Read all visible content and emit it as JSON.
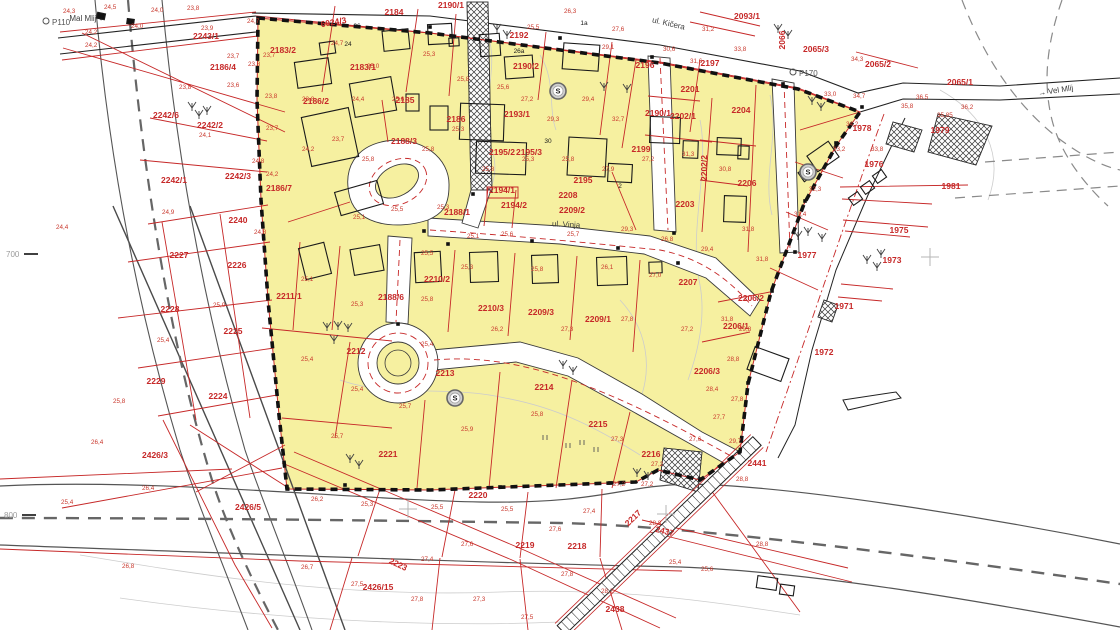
{
  "colors": {
    "zone_fill": "#F6F0A0",
    "parcel_line": "#C62828",
    "boundary": "#111111",
    "road_edge": "#555555",
    "centerline": "#666666",
    "contour": "#cccccc"
  },
  "labels": {
    "parcels": [
      {
        "t": "2243/1",
        "x": 206,
        "y": 39
      },
      {
        "t": "2186/4",
        "x": 223,
        "y": 70
      },
      {
        "t": "2242/6",
        "x": 166,
        "y": 118
      },
      {
        "t": "2242/2",
        "x": 210,
        "y": 128
      },
      {
        "t": "2242/1",
        "x": 174,
        "y": 183
      },
      {
        "t": "2242/3",
        "x": 238,
        "y": 179
      },
      {
        "t": "2240",
        "x": 238,
        "y": 223
      },
      {
        "t": "2227",
        "x": 179,
        "y": 258
      },
      {
        "t": "2226",
        "x": 237,
        "y": 268
      },
      {
        "t": "2228",
        "x": 170,
        "y": 312
      },
      {
        "t": "2225",
        "x": 233,
        "y": 334
      },
      {
        "t": "2229",
        "x": 156,
        "y": 384
      },
      {
        "t": "2224",
        "x": 218,
        "y": 399
      },
      {
        "t": "2426/3",
        "x": 155,
        "y": 458
      },
      {
        "t": "2426/5",
        "x": 248,
        "y": 510
      },
      {
        "t": "6024/3",
        "x": 334,
        "y": 25,
        "r": -10
      },
      {
        "t": "2184",
        "x": 394,
        "y": 15
      },
      {
        "t": "2190/1",
        "x": 451,
        "y": 8
      },
      {
        "t": "2192",
        "x": 519,
        "y": 38
      },
      {
        "t": "2093/1",
        "x": 747,
        "y": 19
      },
      {
        "t": "2065/3",
        "x": 816,
        "y": 52
      },
      {
        "t": "2065/2",
        "x": 878,
        "y": 67
      },
      {
        "t": "2065/1",
        "x": 960,
        "y": 85
      },
      {
        "t": "2183/2",
        "x": 283,
        "y": 53
      },
      {
        "t": "2183/1",
        "x": 363,
        "y": 70
      },
      {
        "t": "2190/2",
        "x": 526,
        "y": 69
      },
      {
        "t": "2185",
        "x": 405,
        "y": 103
      },
      {
        "t": "2186/2",
        "x": 316,
        "y": 104
      },
      {
        "t": "2186",
        "x": 456,
        "y": 122
      },
      {
        "t": "2190/1",
        "x": 658,
        "y": 116
      },
      {
        "t": "2193/1",
        "x": 517,
        "y": 117
      },
      {
        "t": "2188/3",
        "x": 404,
        "y": 144
      },
      {
        "t": "2196",
        "x": 645,
        "y": 68
      },
      {
        "t": "2197",
        "x": 710,
        "y": 66
      },
      {
        "t": "2201",
        "x": 690,
        "y": 92
      },
      {
        "t": "2202/1",
        "x": 683,
        "y": 119
      },
      {
        "t": "2202/2",
        "x": 707,
        "y": 168,
        "r": -90
      },
      {
        "t": "2204",
        "x": 741,
        "y": 113
      },
      {
        "t": "2066",
        "x": 785,
        "y": 40,
        "r": -90
      },
      {
        "t": "2199",
        "x": 641,
        "y": 152
      },
      {
        "t": "2195/2",
        "x": 502,
        "y": 155
      },
      {
        "t": "2195/3",
        "x": 529,
        "y": 155
      },
      {
        "t": "2186/7",
        "x": 279,
        "y": 191
      },
      {
        "t": "2195",
        "x": 583,
        "y": 183
      },
      {
        "t": "2208",
        "x": 568,
        "y": 198
      },
      {
        "t": "2203",
        "x": 685,
        "y": 207
      },
      {
        "t": "2206",
        "x": 747,
        "y": 186
      },
      {
        "t": "1978",
        "x": 862,
        "y": 131
      },
      {
        "t": "1979",
        "x": 940,
        "y": 133
      },
      {
        "t": "1976",
        "x": 874,
        "y": 167
      },
      {
        "t": "1981",
        "x": 951,
        "y": 189
      },
      {
        "t": "1977",
        "x": 807,
        "y": 258
      },
      {
        "t": "1975",
        "x": 899,
        "y": 233
      },
      {
        "t": "1973",
        "x": 892,
        "y": 263
      },
      {
        "t": "1971",
        "x": 844,
        "y": 309
      },
      {
        "t": "1972",
        "x": 824,
        "y": 355
      },
      {
        "t": "2188/1",
        "x": 457,
        "y": 215
      },
      {
        "t": "2194/1",
        "x": 502,
        "y": 193
      },
      {
        "t": "2194/2",
        "x": 514,
        "y": 208
      },
      {
        "t": "2209/2",
        "x": 572,
        "y": 213
      },
      {
        "t": "2211/1",
        "x": 289,
        "y": 299
      },
      {
        "t": "2188/6",
        "x": 391,
        "y": 300
      },
      {
        "t": "2210/2",
        "x": 437,
        "y": 282
      },
      {
        "t": "2210/3",
        "x": 491,
        "y": 311
      },
      {
        "t": "2209/3",
        "x": 541,
        "y": 315
      },
      {
        "t": "2209/1",
        "x": 598,
        "y": 322
      },
      {
        "t": "2207",
        "x": 688,
        "y": 285
      },
      {
        "t": "2206/2",
        "x": 751,
        "y": 301
      },
      {
        "t": "2206/1",
        "x": 736,
        "y": 329
      },
      {
        "t": "2206/3",
        "x": 707,
        "y": 374
      },
      {
        "t": "2212",
        "x": 356,
        "y": 354
      },
      {
        "t": "2213",
        "x": 445,
        "y": 376
      },
      {
        "t": "2214",
        "x": 544,
        "y": 390
      },
      {
        "t": "2215",
        "x": 598,
        "y": 427
      },
      {
        "t": "2216",
        "x": 651,
        "y": 457
      },
      {
        "t": "2221",
        "x": 388,
        "y": 457
      },
      {
        "t": "2220",
        "x": 478,
        "y": 498
      },
      {
        "t": "2219",
        "x": 525,
        "y": 548
      },
      {
        "t": "2218",
        "x": 577,
        "y": 549
      },
      {
        "t": "2223",
        "x": 397,
        "y": 567,
        "r": 25
      },
      {
        "t": "2426/15",
        "x": 378,
        "y": 590
      },
      {
        "t": "2217",
        "x": 635,
        "y": 520,
        "r": -44
      },
      {
        "t": "2437",
        "x": 664,
        "y": 534,
        "r": 14
      },
      {
        "t": "2438",
        "x": 615,
        "y": 612
      },
      {
        "t": "2441",
        "x": 757,
        "y": 466
      }
    ],
    "elevations": [
      [
        104,
        9,
        "24,5"
      ],
      [
        63,
        13,
        "24,3"
      ],
      [
        151,
        12,
        "24,0"
      ],
      [
        187,
        10,
        "23,8"
      ],
      [
        247,
        23,
        "24,7"
      ],
      [
        85,
        34,
        "24,2"
      ],
      [
        131,
        28,
        "24,0"
      ],
      [
        201,
        30,
        "23,9"
      ],
      [
        85,
        47,
        "24,2"
      ],
      [
        227,
        58,
        "23,7"
      ],
      [
        263,
        57,
        "23,7"
      ],
      [
        248,
        66,
        "23,8"
      ],
      [
        227,
        87,
        "23,6"
      ],
      [
        179,
        89,
        "23,8"
      ],
      [
        265,
        98,
        "23,8"
      ],
      [
        266,
        130,
        "23,7"
      ],
      [
        199,
        137,
        "24,1"
      ],
      [
        252,
        163,
        "24,8"
      ],
      [
        266,
        176,
        "24,2"
      ],
      [
        162,
        214,
        "24,9"
      ],
      [
        56,
        229,
        "24,4"
      ],
      [
        254,
        234,
        "24,8"
      ],
      [
        213,
        307,
        "25,0"
      ],
      [
        157,
        342,
        "25,4"
      ],
      [
        113,
        403,
        "25,8"
      ],
      [
        91,
        444,
        "26,4"
      ],
      [
        142,
        490,
        "26,4"
      ],
      [
        61,
        504,
        "25,4"
      ],
      [
        122,
        568,
        "26,8"
      ],
      [
        331,
        45,
        "24,7"
      ],
      [
        367,
        68,
        "25,0"
      ],
      [
        423,
        56,
        "25,3"
      ],
      [
        527,
        29,
        "25,5"
      ],
      [
        564,
        13,
        "26,3"
      ],
      [
        612,
        31,
        "27,6"
      ],
      [
        663,
        51,
        "30,6"
      ],
      [
        690,
        63,
        "31,6"
      ],
      [
        734,
        51,
        "33,8"
      ],
      [
        702,
        31,
        "31,2"
      ],
      [
        602,
        49,
        "29,1"
      ],
      [
        582,
        101,
        "29,4"
      ],
      [
        612,
        121,
        "32,7"
      ],
      [
        547,
        121,
        "29,3"
      ],
      [
        521,
        101,
        "27,2"
      ],
      [
        497,
        89,
        "25,6"
      ],
      [
        457,
        81,
        "25,8"
      ],
      [
        392,
        101,
        "25,6"
      ],
      [
        352,
        101,
        "24,4"
      ],
      [
        302,
        101,
        "23,8"
      ],
      [
        332,
        141,
        "23,7"
      ],
      [
        302,
        151,
        "24,2"
      ],
      [
        362,
        161,
        "25,8"
      ],
      [
        422,
        151,
        "25,8"
      ],
      [
        452,
        131,
        "25,3"
      ],
      [
        482,
        171,
        "25,8"
      ],
      [
        522,
        161,
        "25,3"
      ],
      [
        562,
        161,
        "25,8"
      ],
      [
        602,
        171,
        "27,9"
      ],
      [
        642,
        161,
        "27,2"
      ],
      [
        682,
        156,
        "31,3"
      ],
      [
        719,
        171,
        "30,8"
      ],
      [
        742,
        231,
        "31,8"
      ],
      [
        701,
        251,
        "29,4"
      ],
      [
        661,
        241,
        "26,8"
      ],
      [
        621,
        231,
        "29,3"
      ],
      [
        567,
        236,
        "25,7"
      ],
      [
        501,
        236,
        "25,6"
      ],
      [
        467,
        238,
        "25,1"
      ],
      [
        437,
        209,
        "25,3"
      ],
      [
        391,
        211,
        "25,5"
      ],
      [
        353,
        219,
        "25,1"
      ],
      [
        421,
        255,
        "25,5"
      ],
      [
        461,
        269,
        "25,3"
      ],
      [
        531,
        271,
        "25,8"
      ],
      [
        601,
        269,
        "26,1"
      ],
      [
        649,
        277,
        "27,0"
      ],
      [
        301,
        281,
        "25,1"
      ],
      [
        351,
        306,
        "25,3"
      ],
      [
        421,
        301,
        "25,8"
      ],
      [
        491,
        331,
        "26,2"
      ],
      [
        561,
        331,
        "27,3"
      ],
      [
        621,
        321,
        "27,8"
      ],
      [
        681,
        331,
        "27,2"
      ],
      [
        721,
        321,
        "31,8"
      ],
      [
        301,
        361,
        "25,4"
      ],
      [
        421,
        346,
        "25,4"
      ],
      [
        351,
        391,
        "25,4"
      ],
      [
        399,
        408,
        "25,7"
      ],
      [
        461,
        431,
        "25,9"
      ],
      [
        331,
        438,
        "25,7"
      ],
      [
        531,
        416,
        "25,8"
      ],
      [
        611,
        441,
        "27,3"
      ],
      [
        651,
        466,
        "27,2"
      ],
      [
        689,
        441,
        "27,6"
      ],
      [
        713,
        419,
        "27,7"
      ],
      [
        731,
        401,
        "27,8"
      ],
      [
        851,
        61,
        "34,3"
      ],
      [
        824,
        96,
        "33,0"
      ],
      [
        853,
        98,
        "34,7"
      ],
      [
        901,
        108,
        "35,8"
      ],
      [
        961,
        109,
        "36,2"
      ],
      [
        846,
        126,
        "34,2"
      ],
      [
        833,
        151,
        "33,2"
      ],
      [
        809,
        191,
        "32,3"
      ],
      [
        871,
        151,
        "33,8"
      ],
      [
        794,
        216,
        "31,4"
      ],
      [
        756,
        261,
        "31,8"
      ],
      [
        739,
        331,
        "29,8"
      ],
      [
        727,
        361,
        "28,8"
      ],
      [
        706,
        391,
        "28,4"
      ],
      [
        729,
        443,
        "29,7"
      ],
      [
        311,
        501,
        "26,2"
      ],
      [
        361,
        506,
        "25,3"
      ],
      [
        431,
        509,
        "25,5"
      ],
      [
        501,
        511,
        "25,5"
      ],
      [
        613,
        486,
        "27,2"
      ],
      [
        641,
        486,
        "27,2"
      ],
      [
        583,
        513,
        "27,4"
      ],
      [
        549,
        531,
        "27,6"
      ],
      [
        461,
        546,
        "27,6"
      ],
      [
        421,
        561,
        "27,4"
      ],
      [
        561,
        576,
        "27,8"
      ],
      [
        601,
        593,
        "28,2"
      ],
      [
        669,
        564,
        "25,4"
      ],
      [
        701,
        571,
        "25,6"
      ],
      [
        756,
        546,
        "28,8"
      ],
      [
        649,
        525,
        "28,8"
      ],
      [
        351,
        586,
        "27,5"
      ],
      [
        301,
        569,
        "26,7"
      ],
      [
        411,
        601,
        "27,8"
      ],
      [
        473,
        601,
        "27,3"
      ],
      [
        521,
        619,
        "27,5"
      ],
      [
        736,
        481,
        "28,8"
      ],
      [
        916,
        99,
        "36,5"
      ],
      [
        937,
        117,
        "35,85"
      ]
    ],
    "streets": [
      {
        "t": "Mal Mlij",
        "x": 88,
        "y": 21,
        "r": 0,
        "arrow": "left"
      },
      {
        "t": "ul. Kičera",
        "x": 668,
        "y": 26,
        "r": 13
      },
      {
        "t": "ul. Vinja",
        "x": 566,
        "y": 227,
        "r": 3
      },
      {
        "t": "Vel Mlij",
        "x": 1056,
        "y": 93,
        "r": -9,
        "arrow": "right"
      }
    ],
    "controls": [
      {
        "t": "P110",
        "x": 46,
        "y": 23
      },
      {
        "t": "P170",
        "x": 793,
        "y": 74
      }
    ],
    "grid": [
      {
        "t": "700",
        "x": 6,
        "y": 257
      },
      {
        "t": "800",
        "x": 4,
        "y": 518
      }
    ],
    "houses": [
      [
        357,
        28,
        "26"
      ],
      [
        348,
        46,
        "24"
      ],
      [
        519,
        53,
        "26a"
      ],
      [
        548,
        143,
        "30"
      ],
      [
        620,
        188,
        "2"
      ],
      [
        584,
        25,
        "1a"
      ]
    ]
  },
  "symbols": {
    "s_points": [
      [
        558,
        91
      ],
      [
        808,
        172
      ],
      [
        455,
        398
      ]
    ],
    "crosses": [
      [
        930,
        257
      ],
      [
        666,
        514
      ],
      [
        408,
        509
      ]
    ],
    "trees": [
      [
        192,
        108
      ],
      [
        199,
        116
      ],
      [
        207,
        112
      ],
      [
        497,
        30
      ],
      [
        507,
        36
      ],
      [
        778,
        30
      ],
      [
        788,
        36
      ],
      [
        812,
        102
      ],
      [
        821,
        108
      ],
      [
        798,
        237
      ],
      [
        808,
        233
      ],
      [
        822,
        239
      ],
      [
        327,
        328
      ],
      [
        338,
        327
      ],
      [
        348,
        329
      ],
      [
        334,
        341
      ],
      [
        350,
        460
      ],
      [
        359,
        466
      ],
      [
        637,
        474
      ],
      [
        648,
        477
      ],
      [
        563,
        366
      ],
      [
        573,
        372
      ],
      [
        867,
        261
      ],
      [
        877,
        268
      ],
      [
        881,
        255
      ],
      [
        604,
        88
      ],
      [
        627,
        90
      ]
    ],
    "grass": [
      [
        582,
        445
      ],
      [
        596,
        452
      ],
      [
        568,
        448
      ],
      [
        545,
        440
      ]
    ],
    "monuments": [
      [
        448,
        244
      ],
      [
        532,
        241
      ],
      [
        618,
        248
      ],
      [
        678,
        263
      ],
      [
        424,
        231
      ],
      [
        398,
        324
      ],
      [
        473,
        194
      ],
      [
        652,
        57
      ],
      [
        674,
        233
      ],
      [
        783,
        84
      ],
      [
        795,
        252
      ],
      [
        862,
        107
      ],
      [
        836,
        143
      ],
      [
        805,
        201
      ],
      [
        772,
        291
      ],
      [
        748,
        383
      ],
      [
        700,
        479
      ],
      [
        287,
        487
      ],
      [
        430,
        27
      ],
      [
        560,
        38
      ],
      [
        345,
        485
      ],
      [
        500,
        487
      ],
      [
        610,
        483
      ]
    ]
  }
}
